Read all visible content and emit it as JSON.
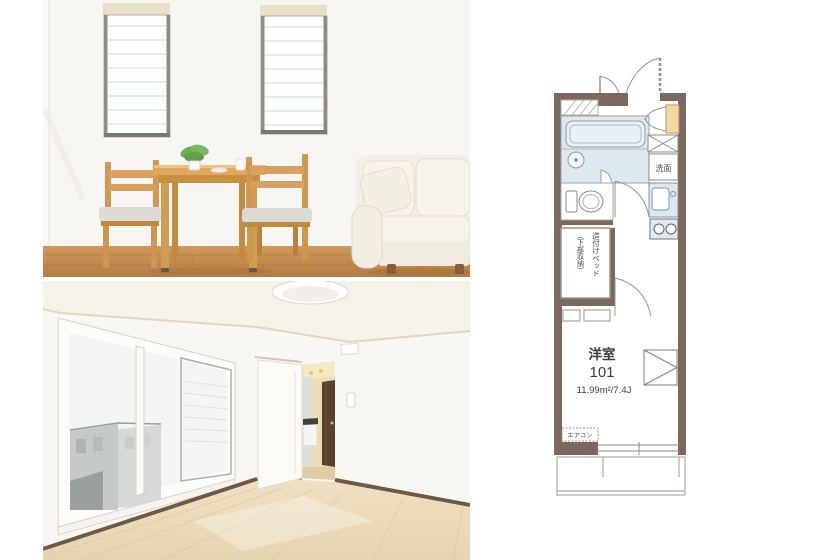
{
  "page": {
    "background": "#ffffff"
  },
  "floorplan": {
    "room_label": "洋室",
    "room_number": "101",
    "area": "11.99m²/7.4J",
    "washbasin": "洗面",
    "aircon": "エアコン",
    "bed_main": "造付けベッド",
    "bed_sub": "（下部収納）",
    "colors": {
      "wall": "#7c685c",
      "bathroom_fill": "#dde9ef",
      "tub_fill": "#eaf1f5",
      "kitchen_fill": "#dce8f0",
      "stove_fill": "#e3eaee",
      "closet_fill": "#f6d8a4",
      "line": "#8a8a8a",
      "text": "#3d3c36"
    }
  },
  "photos": {
    "top_palette": {
      "wall": "#f8f6f2",
      "wood_floor": "#c98f55",
      "table_wood": "#dfa75e",
      "sofa": "#f3efe5",
      "cushion": "#dcdad6"
    },
    "bottom_palette": {
      "wall": "#f9f7f2",
      "floor": "#ecdfc2",
      "hall_glow": "#ecdcba",
      "end_door": "#57432f",
      "baseboard": "#6e5846"
    }
  }
}
